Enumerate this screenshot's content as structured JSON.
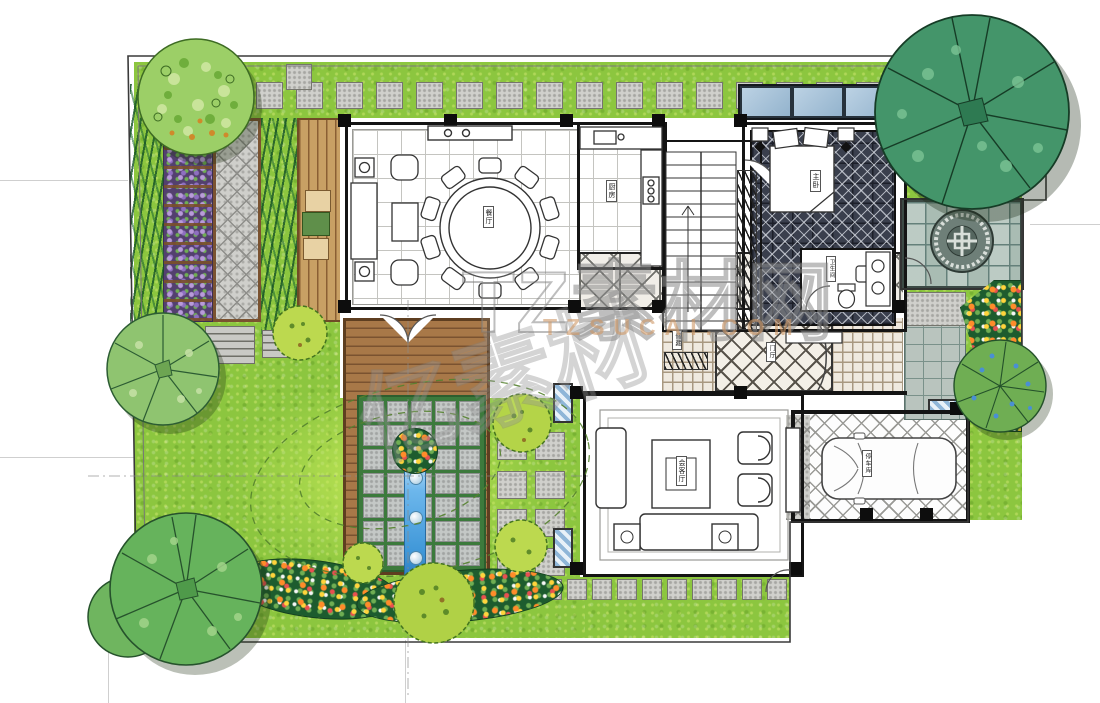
{
  "watermark": {
    "brand_large": "TZ素材网",
    "brand_url": "TZSUCAI.COM",
    "brand_partial": "亿素材"
  },
  "room_labels": {
    "dining": "餐厅",
    "kitchen": "厨房",
    "master_bedroom": "主卧",
    "bathroom": "卫生间",
    "storage": "储藏",
    "entry_hall": "门厅",
    "living": "会客厅",
    "parking": "停车库"
  },
  "palette": {
    "grass": "#8cc63f",
    "lawn_highlight": "#b9e14e",
    "deck_wood": "#a87848",
    "patio_wood": "#c8a064",
    "water": "#3f97d8",
    "skylight_glass": "#a9c6de",
    "tree_dark": "#44956a",
    "tree_light": "#8fc470",
    "shrub": "#bcd94f",
    "wisteria": "#7b5ea8",
    "flower_orange": "#ff8c2a",
    "flower_yellow": "#ffd43b",
    "stone": "#d0d0cc",
    "carpet": "#3a3f4d"
  }
}
